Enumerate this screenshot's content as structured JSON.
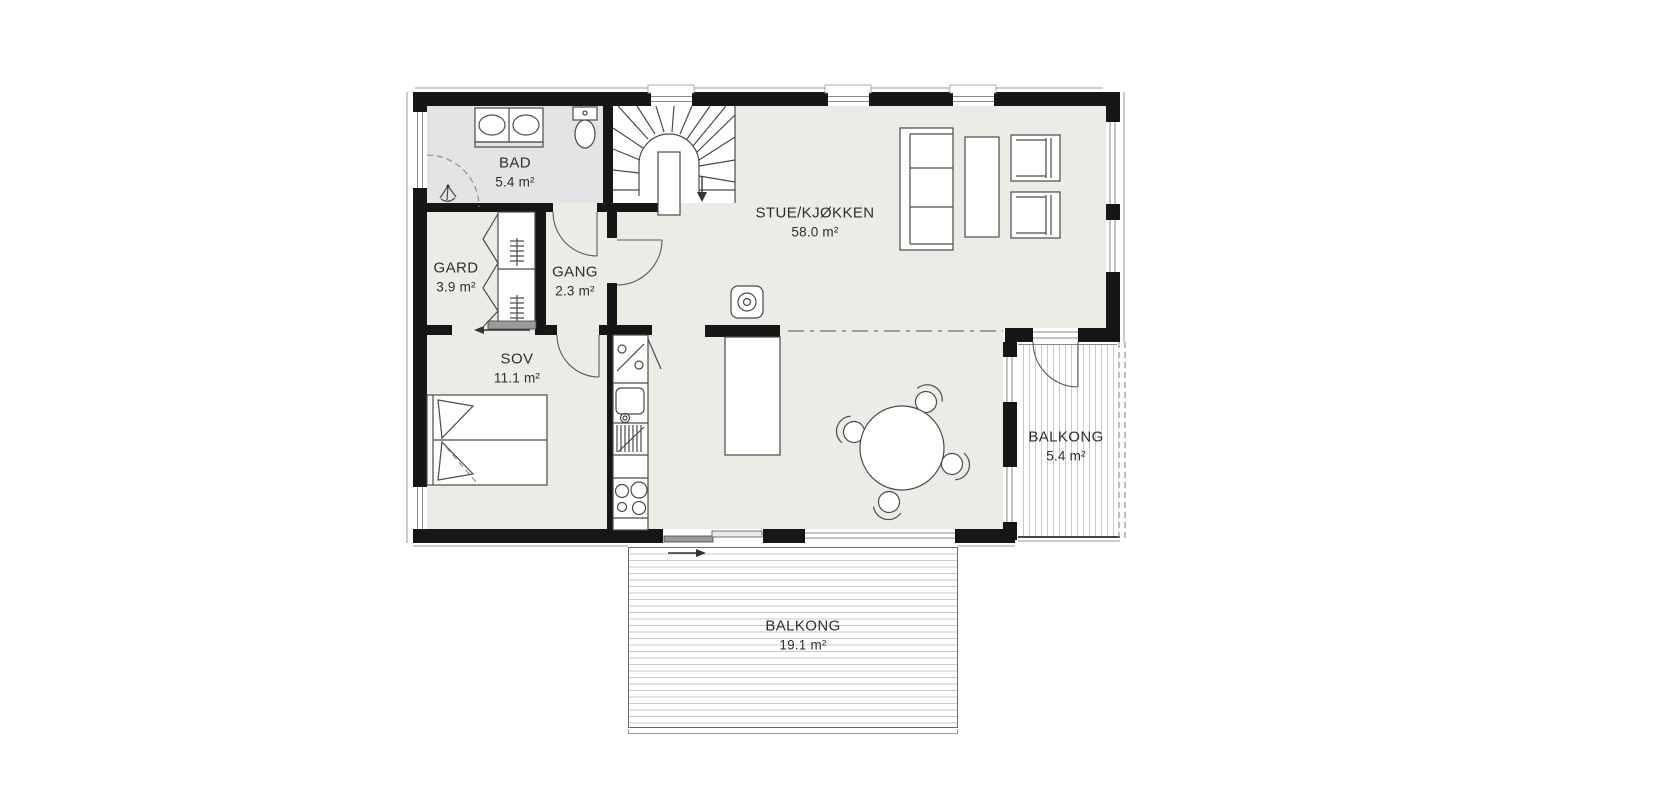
{
  "floorplan": {
    "rooms": [
      {
        "id": "bad",
        "name": "BAD",
        "area": "5.4 m²"
      },
      {
        "id": "gard",
        "name": "GARD",
        "area": "3.9 m²"
      },
      {
        "id": "gang",
        "name": "GANG",
        "area": "2.3 m²"
      },
      {
        "id": "sov",
        "name": "SOV",
        "area": "11.1 m²"
      },
      {
        "id": "stue_kjokken",
        "name": "STUE/KJØKKEN",
        "area": "58.0 m²"
      },
      {
        "id": "balkong_east",
        "name": "BALKONG",
        "area": "5.4 m²"
      },
      {
        "id": "balkong_south",
        "name": "BALKONG",
        "area": "19.1 m²"
      }
    ],
    "colors": {
      "wall": "#161616",
      "floor": "#ecebe6",
      "bathroom_floor": "#e4e4e7",
      "deck_stripe": "#c9c9c9",
      "fixture_line": "#4a4a4a",
      "label_text": "#2e2e2e"
    },
    "fixtures": [
      "staircase",
      "stair-direction-arrow",
      "toilet",
      "double-sink-vanity",
      "shower",
      "wardrobe",
      "sliding-door",
      "double-bed",
      "kitchen-counter",
      "dishwasher-symbol",
      "kitchen-sink",
      "stove",
      "kitchen-island",
      "fireplace",
      "dining-table",
      "dining-chair",
      "sofa",
      "coffee-table",
      "armchair",
      "hinged-door",
      "window",
      "section-line",
      "balcony-deck"
    ]
  }
}
